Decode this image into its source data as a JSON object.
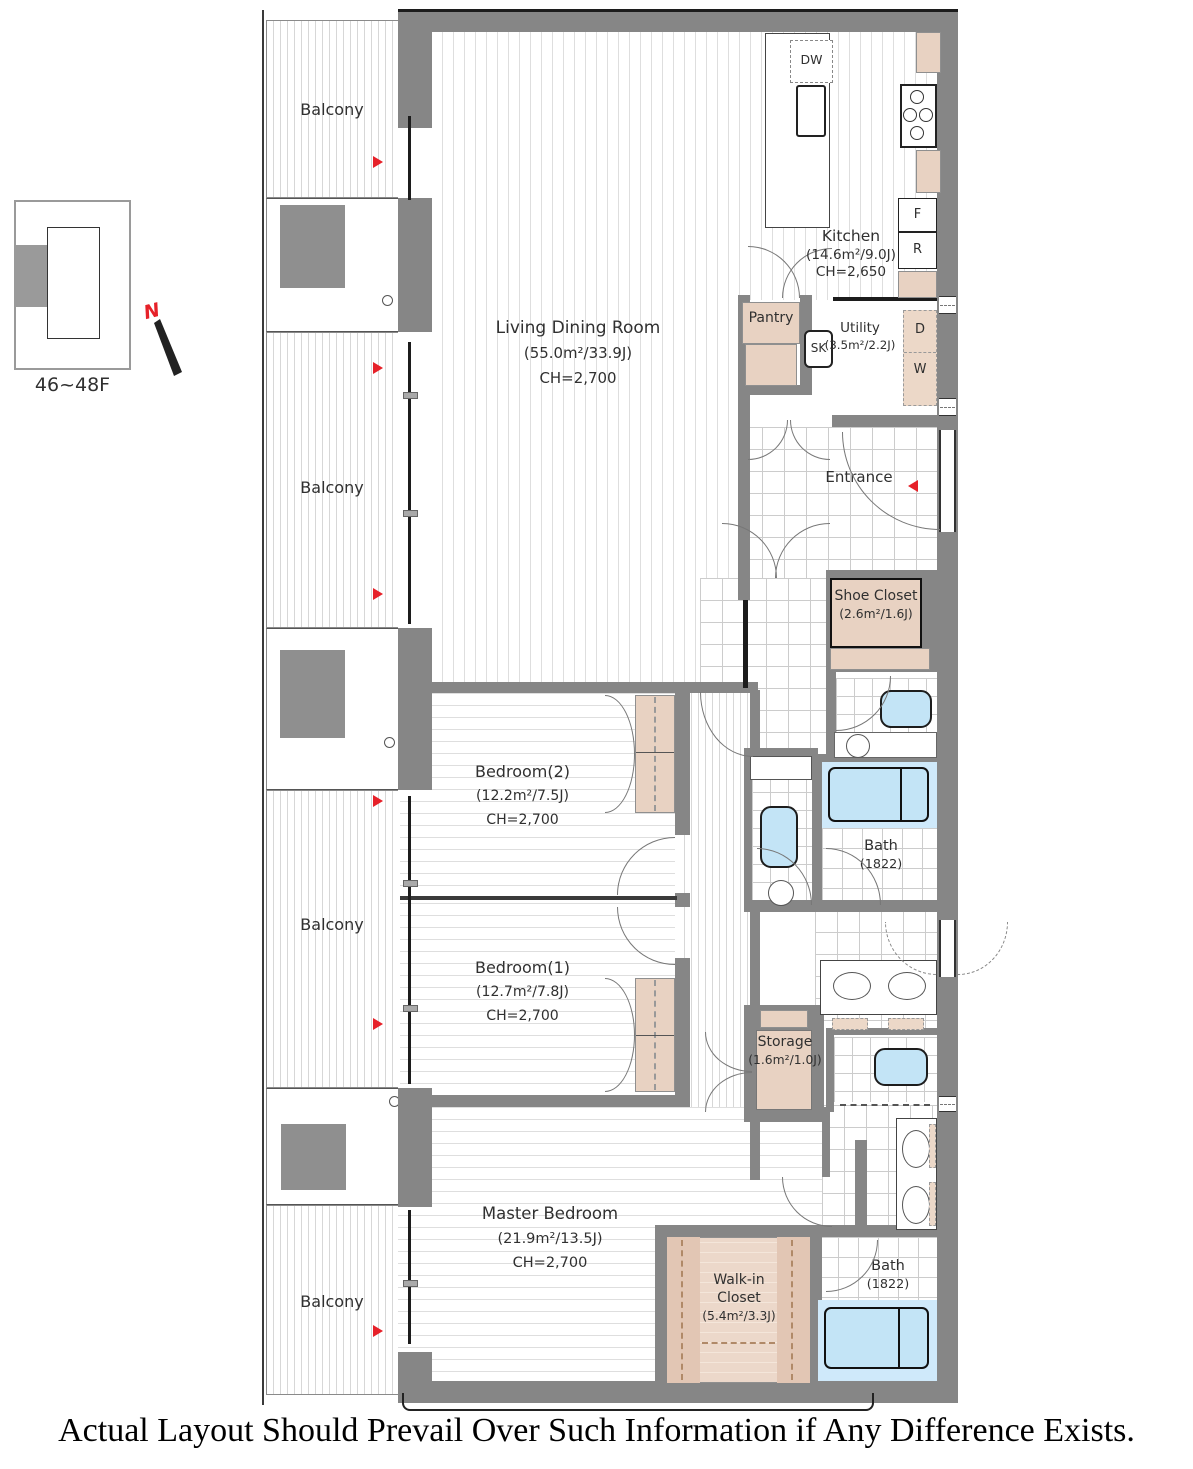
{
  "key_plan": {
    "floor_range": "46~48F",
    "north_letter": "N"
  },
  "labels": {
    "balcony": "Balcony",
    "entrance": "Entrance",
    "living": {
      "name": "Living Dining Room",
      "area": "(55.0m²/33.9J)",
      "ceiling": "CH=2,700"
    },
    "kitchen": {
      "name": "Kitchen",
      "area": "(14.6m²/9.0J)",
      "ceiling": "CH=2,650"
    },
    "pantry": {
      "name": "Pantry"
    },
    "utility": {
      "name": "Utility",
      "area": "(3.5m²/2.2J)"
    },
    "shoe_closet": {
      "name": "Shoe Closet",
      "area": "(2.6m²/1.6J)"
    },
    "bedroom2": {
      "name": "Bedroom(2)",
      "area": "(12.2m²/7.5J)",
      "ceiling": "CH=2,700"
    },
    "bedroom1": {
      "name": "Bedroom(1)",
      "area": "(12.7m²/7.8J)",
      "ceiling": "CH=2,700"
    },
    "master_bedroom": {
      "name": "Master Bedroom",
      "area": "(21.9m²/13.5J)",
      "ceiling": "CH=2,700"
    },
    "walk_in_closet": {
      "line1": "Walk-in",
      "line2": "Closet",
      "area": "(5.4m²/3.3J)"
    },
    "storage": {
      "name": "Storage",
      "area": "(1.6m²/1.0J)"
    },
    "bath_upper": {
      "name": "Bath",
      "dim": "(1822)"
    },
    "bath_lower": {
      "name": "Bath",
      "dim": "(1822)"
    }
  },
  "fixtures": {
    "dishwasher": "DW",
    "kitchen_sink": "SK",
    "freezer": "F",
    "refrigerator": "R",
    "dryer": "D",
    "washer": "W"
  },
  "disclaimer": "Actual Layout Should Prevail Over Such Information if Any Difference Exists.",
  "colors": {
    "wall": "#868686",
    "closet_fill": "#e8d2c2",
    "water_fixture": "#c3e4f6",
    "accent_red": "#e62129"
  }
}
